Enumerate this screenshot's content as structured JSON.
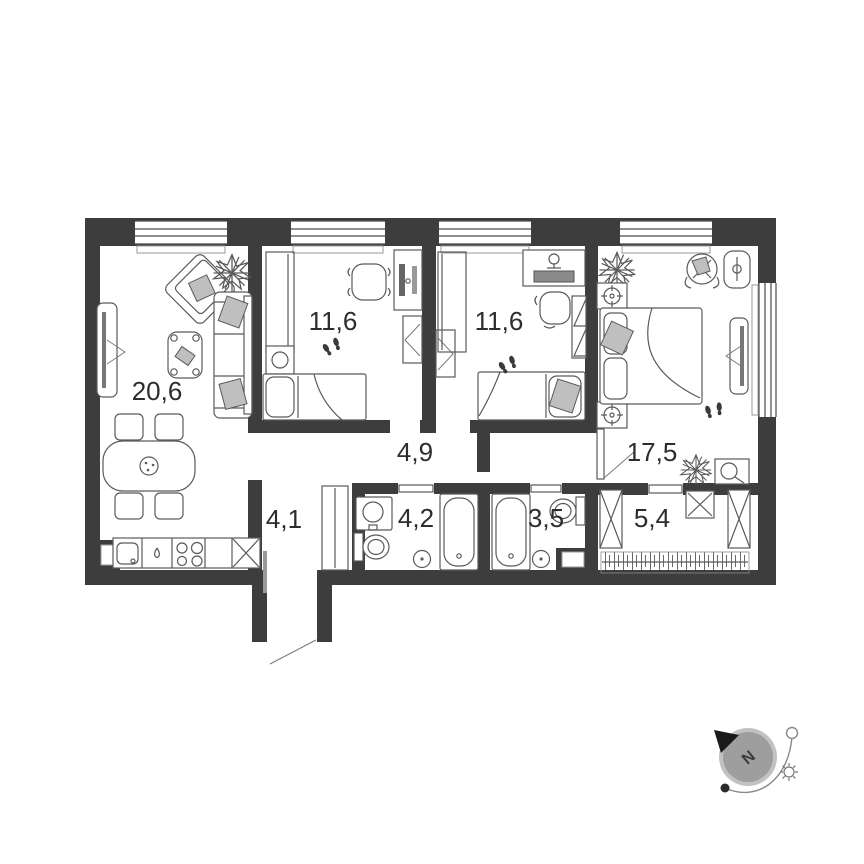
{
  "plan": {
    "type": "apartment-floor-plan",
    "rooms": [
      {
        "id": "living-kitchen",
        "area": "20,6"
      },
      {
        "id": "bedroom-1",
        "area": "11,6"
      },
      {
        "id": "bedroom-2",
        "area": "11,6"
      },
      {
        "id": "bedroom-3",
        "area": "17,5"
      },
      {
        "id": "hallway",
        "area": "4,9"
      },
      {
        "id": "corridor",
        "area": "4,1"
      },
      {
        "id": "bathroom-1",
        "area": "4,2"
      },
      {
        "id": "bathroom-2",
        "area": "3,5"
      },
      {
        "id": "walk-in-closet",
        "area": "5,4"
      }
    ]
  },
  "compass": {
    "north_label": "N"
  },
  "colors": {
    "wall": "#3d3d3d",
    "furniture_line": "#5a5a5a",
    "cushion_fill": "#bfbfbf",
    "text": "#2d2d2d",
    "background": "#ffffff",
    "compass_disc": "#9e9e9e"
  }
}
